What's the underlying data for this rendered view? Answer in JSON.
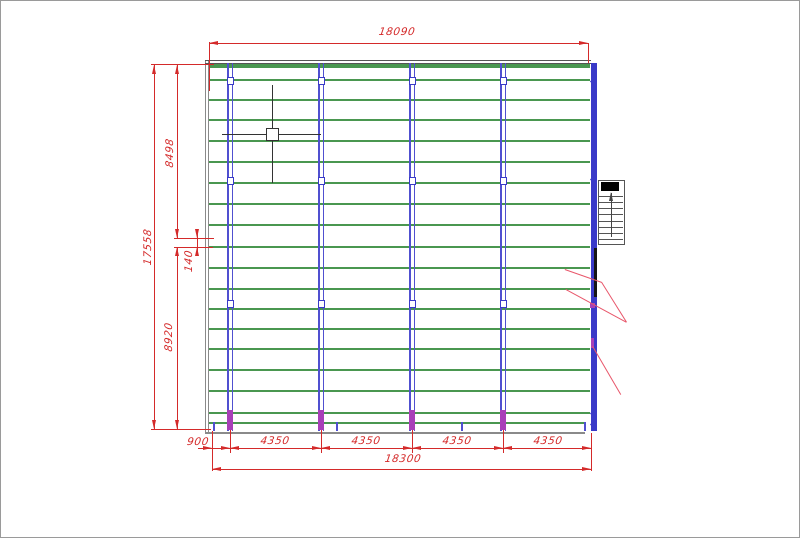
{
  "dim_labels": {
    "top_width": "18090",
    "total_width": "18300",
    "left_total": "17558",
    "left_upper": "8498",
    "left_gap": "140",
    "left_lower": "8920",
    "bottom_segments": [
      "900",
      "4350",
      "4350",
      "4350",
      "4350"
    ]
  },
  "colors": {
    "dimension": "#d42a2a",
    "leader": "#e8566a",
    "purlin_green": "#4a9750",
    "column_blue": "#5050d0",
    "edge_blue": "#3a3ac8",
    "magenta": "#a840b8",
    "frame_gray": "#8a8a8a",
    "frame_dark": "#555555",
    "black": "#151515",
    "cursor": "#333333"
  },
  "geometry": {
    "frame": {
      "left_x": 204,
      "right_x": 590,
      "top_y": 59,
      "bottom_y": 430
    },
    "purlins_y": [
      78,
      98,
      118,
      139,
      160,
      181,
      202,
      223,
      245,
      266,
      287,
      307,
      327,
      347,
      368,
      389,
      411
    ],
    "purlin_x1": 208,
    "purlin_x2": 589,
    "top_band_y": 63,
    "bottom_band_y": 421,
    "columns_x": [
      229,
      320,
      411,
      502
    ],
    "column_top_y": 62,
    "column_bottom_y": 430,
    "column_marker_y": [
      79,
      179,
      302
    ],
    "right_marker_y": [
      80,
      178,
      412,
      423
    ],
    "bottom_ticks_x": [
      212,
      335,
      460,
      583
    ],
    "leader_lines": [
      [
        564,
        268,
        601,
        281
      ],
      [
        565,
        288,
        626,
        321
      ],
      [
        601,
        281,
        626,
        321
      ],
      [
        592,
        345,
        620,
        393
      ]
    ],
    "black_segment": {
      "x": 593,
      "y1": 247,
      "y2": 296
    },
    "stair_symbol": {
      "x": 597,
      "y": 179,
      "width": 25,
      "height": 63,
      "rows": 7
    },
    "cursor": {
      "x": 271,
      "y": 133
    },
    "dim_boundaries_x": [
      211,
      229,
      320,
      411,
      502,
      590
    ]
  }
}
